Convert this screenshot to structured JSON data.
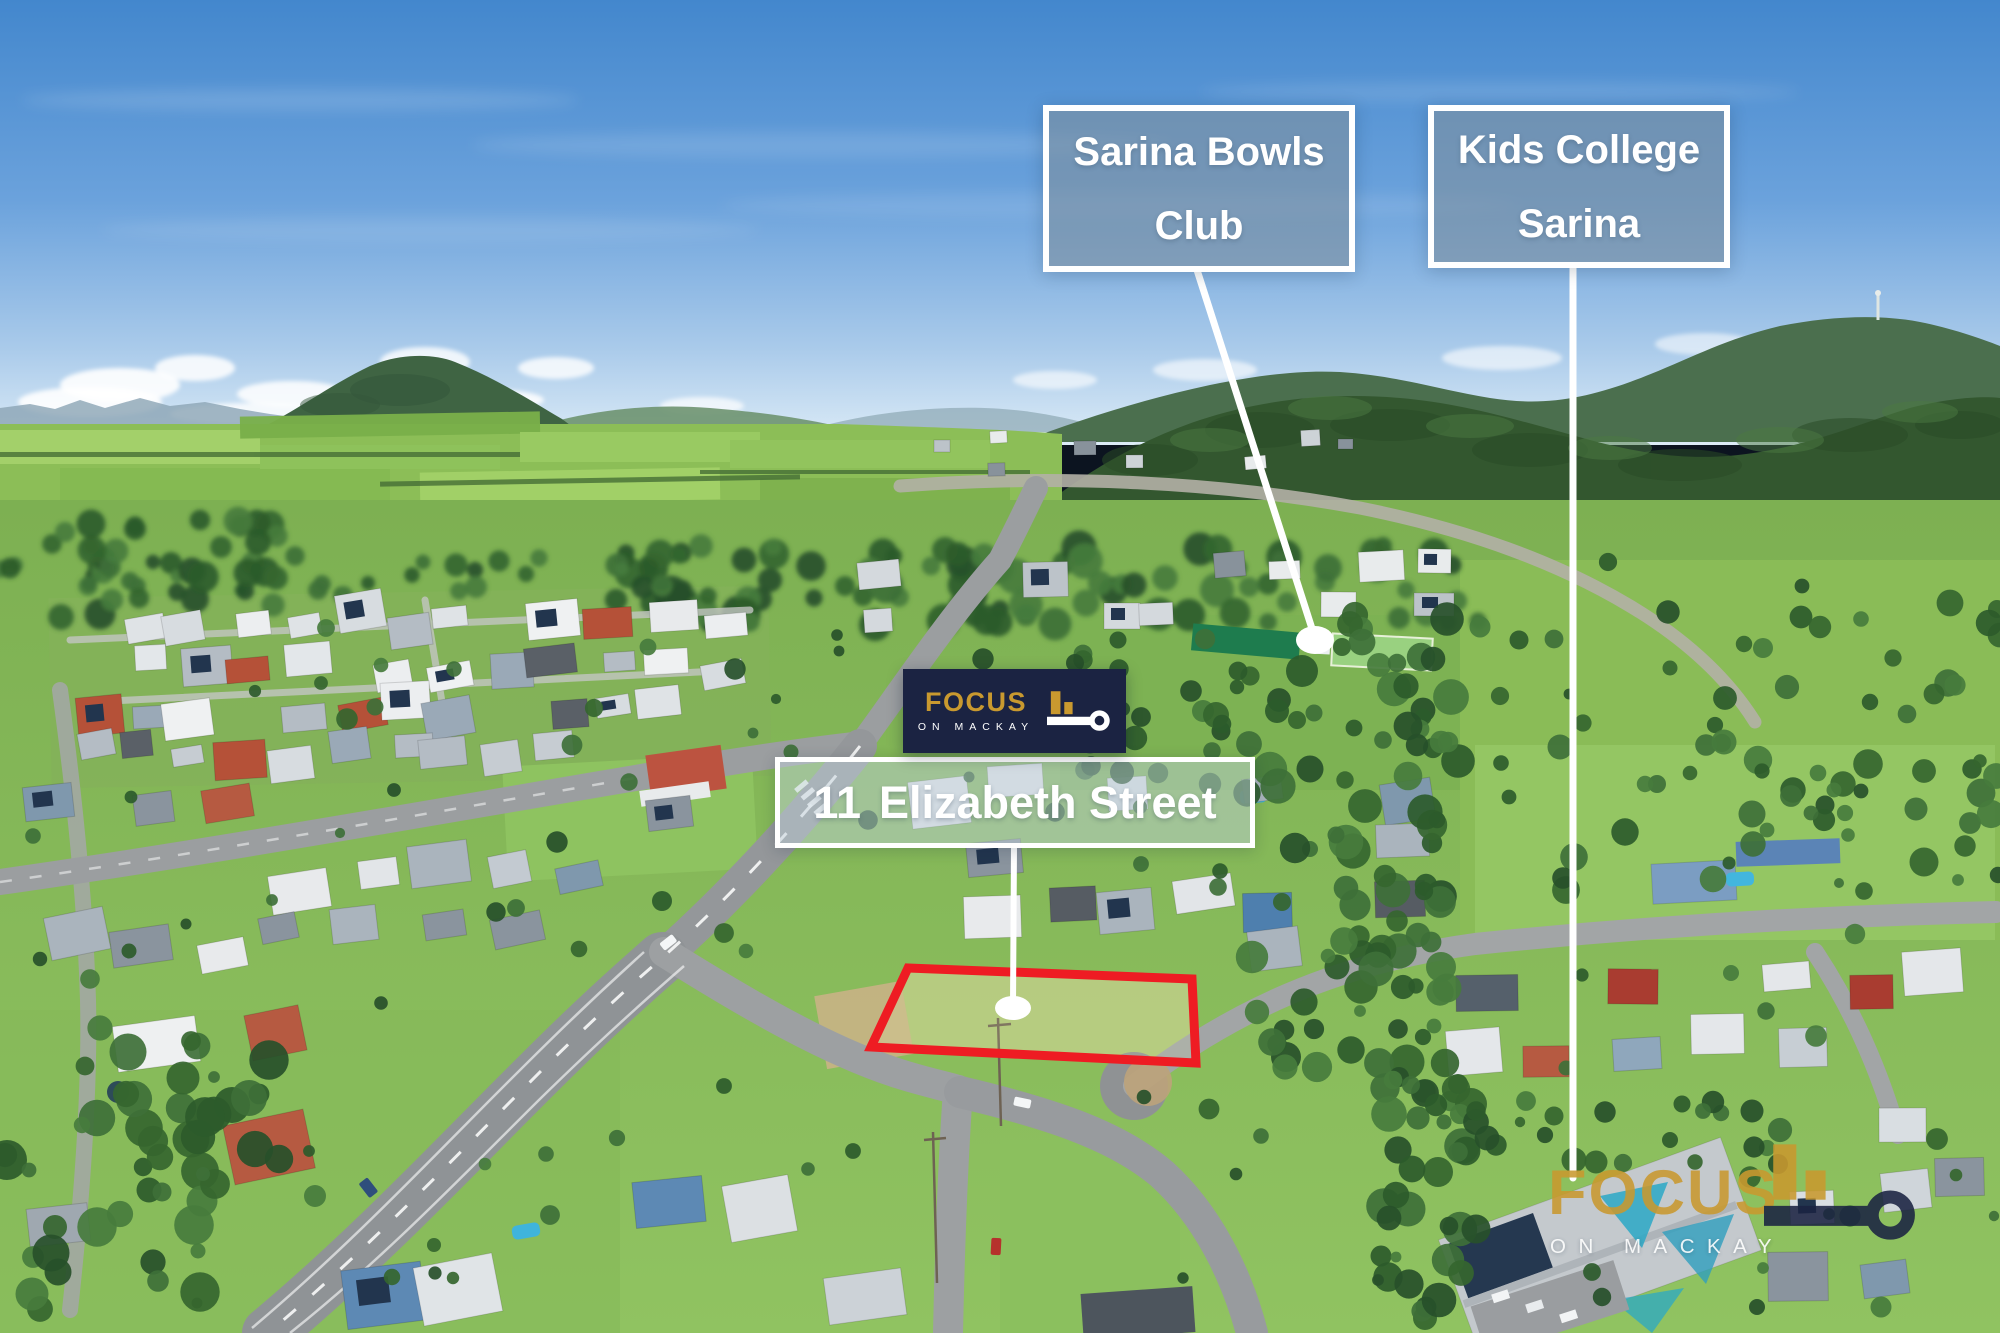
{
  "poi_labels": [
    {
      "line1": "Sarina Bowls",
      "line2": "Club"
    },
    {
      "line1": "Kids College",
      "line2": "Sarina"
    }
  ],
  "property_label": {
    "street_number": "11",
    "street_name": "Elizabeth Street"
  },
  "branding_badge": {
    "title": "FOCUS",
    "subtitle": "ON MACKAY"
  },
  "watermark": {
    "title": "FOCUS",
    "subtitle": "ON MACKAY"
  },
  "colors": {
    "brand_navy": "#1B2342",
    "brand_gold": "#C9992F",
    "boundary_red": "#EE1C23",
    "leader_line_white": "#FFFFFF"
  }
}
